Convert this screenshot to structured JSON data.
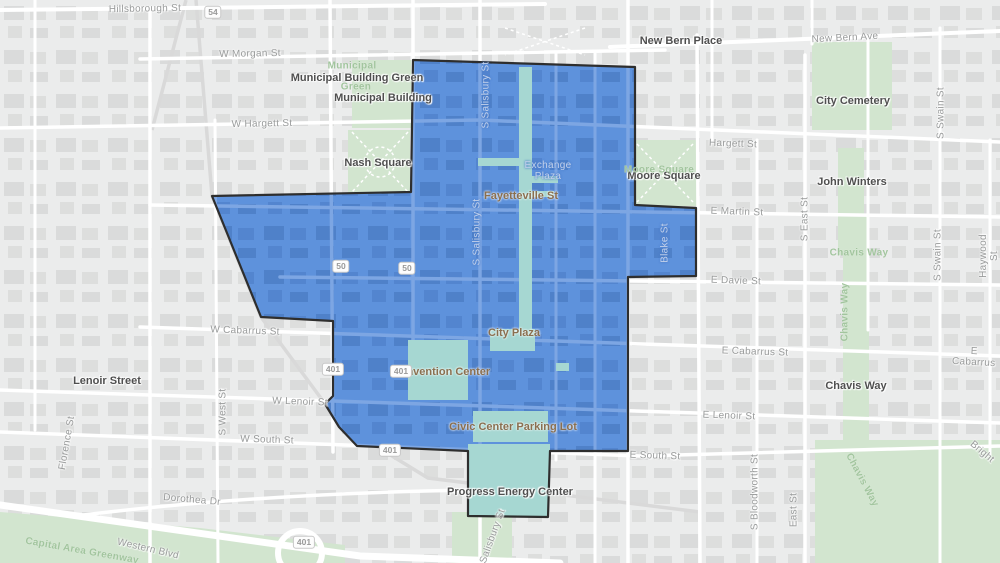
{
  "map": {
    "district_overlay": {
      "name": "downtown-district-boundary",
      "fill": "#5e92dc",
      "building_fill": "#4f81c9",
      "street_fill": "#7da6e3",
      "outline": "#2e2e2e",
      "plaza_fill": "#a6d7d2"
    },
    "colors": {
      "land": "#ebecec",
      "buildings": "#dadbdb",
      "streets": "#ffffff",
      "parks": "#d2e5cf",
      "poi_dark_label": "#4f4f4f",
      "poi_brown_label": "#8a6f4f",
      "street_label": "#999b9b",
      "park_label": "#a2c59e"
    },
    "labels": [
      {
        "text": "New Bern Place",
        "x": 681,
        "y": 41,
        "rotate": 0,
        "cls": "poi-dark"
      },
      {
        "text": "Municipal Building Green",
        "x": 357,
        "y": 78,
        "rotate": 0,
        "cls": "poi-dark"
      },
      {
        "text": "Municipal Building",
        "x": 383,
        "y": 98,
        "rotate": 0,
        "cls": "poi-dark"
      },
      {
        "text": "Nash Square",
        "x": 378,
        "y": 163,
        "rotate": 0,
        "cls": "poi-dark"
      },
      {
        "text": "Moore Square",
        "x": 664,
        "y": 176,
        "rotate": 0,
        "cls": "poi-dark"
      },
      {
        "text": "City Cemetery",
        "x": 853,
        "y": 101,
        "rotate": 0,
        "cls": "poi-dark"
      },
      {
        "text": "John Winters",
        "x": 852,
        "y": 182,
        "rotate": 0,
        "cls": "poi-dark"
      },
      {
        "text": "Lenoir Street",
        "x": 107,
        "y": 381,
        "rotate": 0,
        "cls": "poi-dark"
      },
      {
        "text": "Chavis Way",
        "x": 856,
        "y": 386,
        "rotate": 0,
        "cls": "poi-dark"
      },
      {
        "text": "Progress Energy Center",
        "x": 510,
        "y": 492,
        "rotate": 0,
        "cls": "poi-dark"
      },
      {
        "text": "Fayetteville St",
        "x": 521,
        "y": 196,
        "rotate": 0,
        "cls": "poi-brown"
      },
      {
        "text": "City Plaza",
        "x": 514,
        "y": 333,
        "rotate": 0,
        "cls": "poi-brown"
      },
      {
        "text": "Convention Center",
        "x": 441,
        "y": 372,
        "rotate": 0,
        "cls": "poi-brown"
      },
      {
        "text": "Civic Center Parking Lot",
        "x": 513,
        "y": 427,
        "rotate": 0,
        "cls": "poi-brown"
      },
      {
        "text": "Municipal",
        "x": 352,
        "y": 66,
        "rotate": 0,
        "cls": "park"
      },
      {
        "text": "Green",
        "x": 356,
        "y": 87,
        "rotate": 0,
        "cls": "park"
      },
      {
        "text": "Moore Square",
        "x": 659,
        "y": 170,
        "rotate": 0,
        "cls": "park"
      },
      {
        "text": "Chavis Way",
        "x": 859,
        "y": 253,
        "rotate": 0,
        "cls": "park"
      },
      {
        "text": "Chavis Way",
        "x": 845,
        "y": 312,
        "rotate": -90,
        "cls": "park"
      },
      {
        "text": "Chavis Way",
        "x": 862,
        "y": 480,
        "rotate": 62,
        "cls": "park"
      },
      {
        "text": "Capital Area Greenway",
        "x": 82,
        "y": 551,
        "rotate": 10,
        "cls": "park"
      },
      {
        "text": "Hillsborough St",
        "x": 145,
        "y": 9,
        "rotate": -1,
        "cls": "street"
      },
      {
        "text": "W Morgan St",
        "x": 250,
        "y": 54,
        "rotate": -1,
        "cls": "street"
      },
      {
        "text": "New Bern Ave",
        "x": 845,
        "y": 38,
        "rotate": -3,
        "cls": "street"
      },
      {
        "text": "W Hargett St",
        "x": 262,
        "y": 124,
        "rotate": -1,
        "cls": "street"
      },
      {
        "text": "Hargett St",
        "x": 733,
        "y": 144,
        "rotate": 2,
        "cls": "street"
      },
      {
        "text": "E Martin St",
        "x": 737,
        "y": 212,
        "rotate": 2,
        "cls": "street"
      },
      {
        "text": "E Davie St",
        "x": 736,
        "y": 281,
        "rotate": 2,
        "cls": "street"
      },
      {
        "text": "W Cabarrus St",
        "x": 245,
        "y": 331,
        "rotate": 2,
        "cls": "street"
      },
      {
        "text": "E Cabarrus St",
        "x": 755,
        "y": 352,
        "rotate": 2,
        "cls": "street"
      },
      {
        "text": "E Cabarrus",
        "x": 974,
        "y": 357,
        "rotate": 3,
        "cls": "street"
      },
      {
        "text": "W Lenoir St",
        "x": 300,
        "y": 402,
        "rotate": 2,
        "cls": "street"
      },
      {
        "text": "E Lenoir St",
        "x": 729,
        "y": 416,
        "rotate": 2,
        "cls": "street"
      },
      {
        "text": "W South St",
        "x": 267,
        "y": 440,
        "rotate": 2,
        "cls": "street"
      },
      {
        "text": "E South St",
        "x": 655,
        "y": 456,
        "rotate": 2,
        "cls": "street"
      },
      {
        "text": "Dorothea Dr",
        "x": 192,
        "y": 500,
        "rotate": 5,
        "cls": "street"
      },
      {
        "text": "Western Blvd",
        "x": 148,
        "y": 549,
        "rotate": 13,
        "cls": "street"
      },
      {
        "text": "Bright",
        "x": 982,
        "y": 452,
        "rotate": 40,
        "cls": "street"
      },
      {
        "text": "S East St",
        "x": 805,
        "y": 219,
        "rotate": -90,
        "cls": "street"
      },
      {
        "text": "S Swain St",
        "x": 941,
        "y": 113,
        "rotate": -90,
        "cls": "street"
      },
      {
        "text": "S Swain St",
        "x": 938,
        "y": 255,
        "rotate": -90,
        "cls": "street"
      },
      {
        "text": "Haywood St",
        "x": 989,
        "y": 256,
        "rotate": -90,
        "cls": "street"
      },
      {
        "text": "S West St",
        "x": 223,
        "y": 412,
        "rotate": -90,
        "cls": "street"
      },
      {
        "text": "Florence St",
        "x": 67,
        "y": 443,
        "rotate": -80,
        "cls": "street"
      },
      {
        "text": "S Bloodworth St",
        "x": 755,
        "y": 492,
        "rotate": -90,
        "cls": "street"
      },
      {
        "text": "East St",
        "x": 794,
        "y": 510,
        "rotate": -90,
        "cls": "street"
      },
      {
        "text": "S Salisbury St",
        "x": 491,
        "y": 541,
        "rotate": -70,
        "cls": "street"
      },
      {
        "text": "S Salisbury St",
        "x": 486,
        "y": 95,
        "rotate": -90,
        "cls": "street-light"
      },
      {
        "text": "S Salisbury St",
        "x": 477,
        "y": 232,
        "rotate": -90,
        "cls": "street-light"
      },
      {
        "text": "Blake St",
        "x": 665,
        "y": 243,
        "rotate": -90,
        "cls": "street-light"
      },
      {
        "text": "Exchange\nPlaza",
        "x": 548,
        "y": 171,
        "rotate": 0,
        "cls": "street-light"
      }
    ],
    "shields": [
      {
        "text": "54",
        "x": 213,
        "y": 12
      },
      {
        "text": "50",
        "x": 341,
        "y": 266
      },
      {
        "text": "50",
        "x": 407,
        "y": 268
      },
      {
        "text": "401",
        "x": 333,
        "y": 369
      },
      {
        "text": "401",
        "x": 401,
        "y": 371
      },
      {
        "text": "401",
        "x": 390,
        "y": 450
      },
      {
        "text": "401",
        "x": 304,
        "y": 542
      }
    ]
  }
}
